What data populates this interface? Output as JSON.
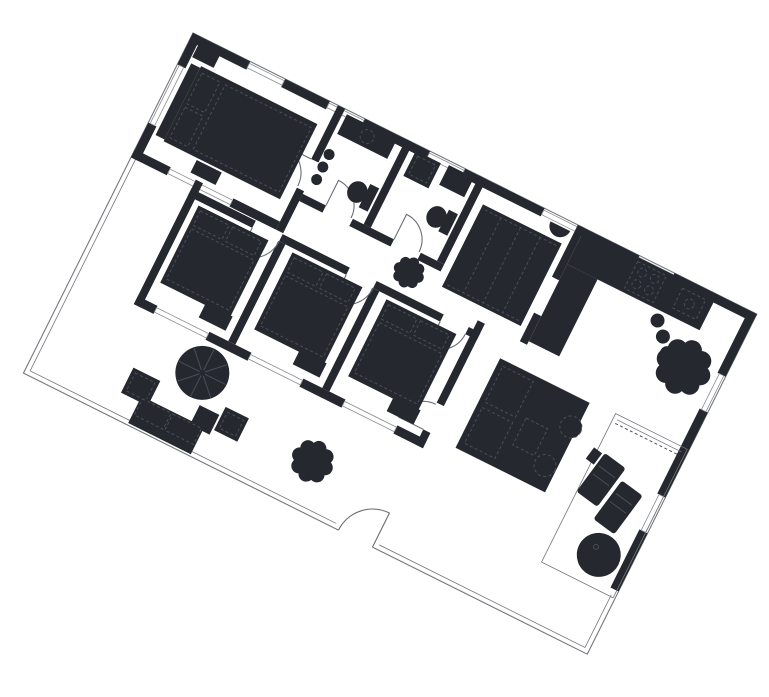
{
  "meta": {
    "kind": "architectural-floor-plan",
    "orientation_note": "plan rotated clockwise",
    "rotation_deg": 26.5
  },
  "canvas": {
    "width": 769,
    "height": 697,
    "background": "#ffffff"
  },
  "plan": {
    "transform": "translate(193,33) rotate(26.5)",
    "width_units": 630,
    "depth_units": 380,
    "wall_thickness": 9
  },
  "colors": {
    "ink": "#26282f",
    "outline": "#74777c",
    "detail": "#4a4e57",
    "window_fill": "#ffffff",
    "window_stroke": "#8a8d92",
    "arc": "#6a6d74"
  },
  "rooms": [
    {
      "id": "bedroom-1",
      "label": "master bedroom (top-left)"
    },
    {
      "id": "bathroom-1",
      "label": "bathroom with sink counter, toilet, radiator"
    },
    {
      "id": "bathroom-2",
      "label": "bathroom with shower, counter, toilet"
    },
    {
      "id": "hallway",
      "label": "entry hall with closet and wall basin"
    },
    {
      "id": "corridor",
      "label": "corridor linking bedrooms"
    },
    {
      "id": "kitchen",
      "label": "kitchen with L counter, stove, sink, stools, plant"
    },
    {
      "id": "bedroom-2",
      "label": "bedroom, bed head to corridor wall"
    },
    {
      "id": "bedroom-3",
      "label": "bedroom, bed head to corridor wall"
    },
    {
      "id": "bedroom-4",
      "label": "bedroom, bed head to corridor wall"
    },
    {
      "id": "dining-living",
      "label": "dining / seating group room"
    },
    {
      "id": "patio",
      "label": "patio with umbrella table, sofa, armchair, pouf, plant"
    },
    {
      "id": "terrace-annex",
      "label": "terrace annex with loungers and round table"
    }
  ],
  "furniture": [
    {
      "room": "bedroom-1",
      "items": [
        "double-bed",
        "pillows",
        "nightstand",
        "dresser"
      ]
    },
    {
      "room": "bathroom-1",
      "items": [
        "sink-counter",
        "toilet",
        "radiator"
      ]
    },
    {
      "room": "bathroom-2",
      "items": [
        "shower",
        "counter",
        "toilet"
      ]
    },
    {
      "room": "hallway",
      "items": [
        "closet-4-sections",
        "wall-basin"
      ]
    },
    {
      "room": "corridor",
      "items": [
        "potted-plant"
      ]
    },
    {
      "room": "kitchen",
      "items": [
        "counter-band",
        "counter-arm",
        "stove-4-burners",
        "sink",
        "stool",
        "stool",
        "stool",
        "potted-plant-large"
      ]
    },
    {
      "room": "bedroom-2",
      "items": [
        "bed",
        "dresser"
      ]
    },
    {
      "room": "bedroom-3",
      "items": [
        "bed",
        "dresser"
      ]
    },
    {
      "room": "bedroom-4",
      "items": [
        "bed",
        "dresser"
      ]
    },
    {
      "room": "dining-living",
      "items": [
        "seating-group-table",
        "round-cushion",
        "round-cushion"
      ]
    },
    {
      "room": "patio",
      "items": [
        "umbrella-table",
        "chair",
        "armchair",
        "sofa",
        "pouf",
        "potted-plant"
      ]
    },
    {
      "room": "terrace-annex",
      "items": [
        "lounger",
        "lounger",
        "round-table",
        "sliding-door"
      ]
    }
  ],
  "doors": [
    "bedroom-1-door",
    "bathroom-1-door",
    "bathroom-2-door",
    "bedroom-2-door",
    "bedroom-3-door",
    "bedroom-4-door",
    "dining-door",
    "patio-exit-door"
  ]
}
